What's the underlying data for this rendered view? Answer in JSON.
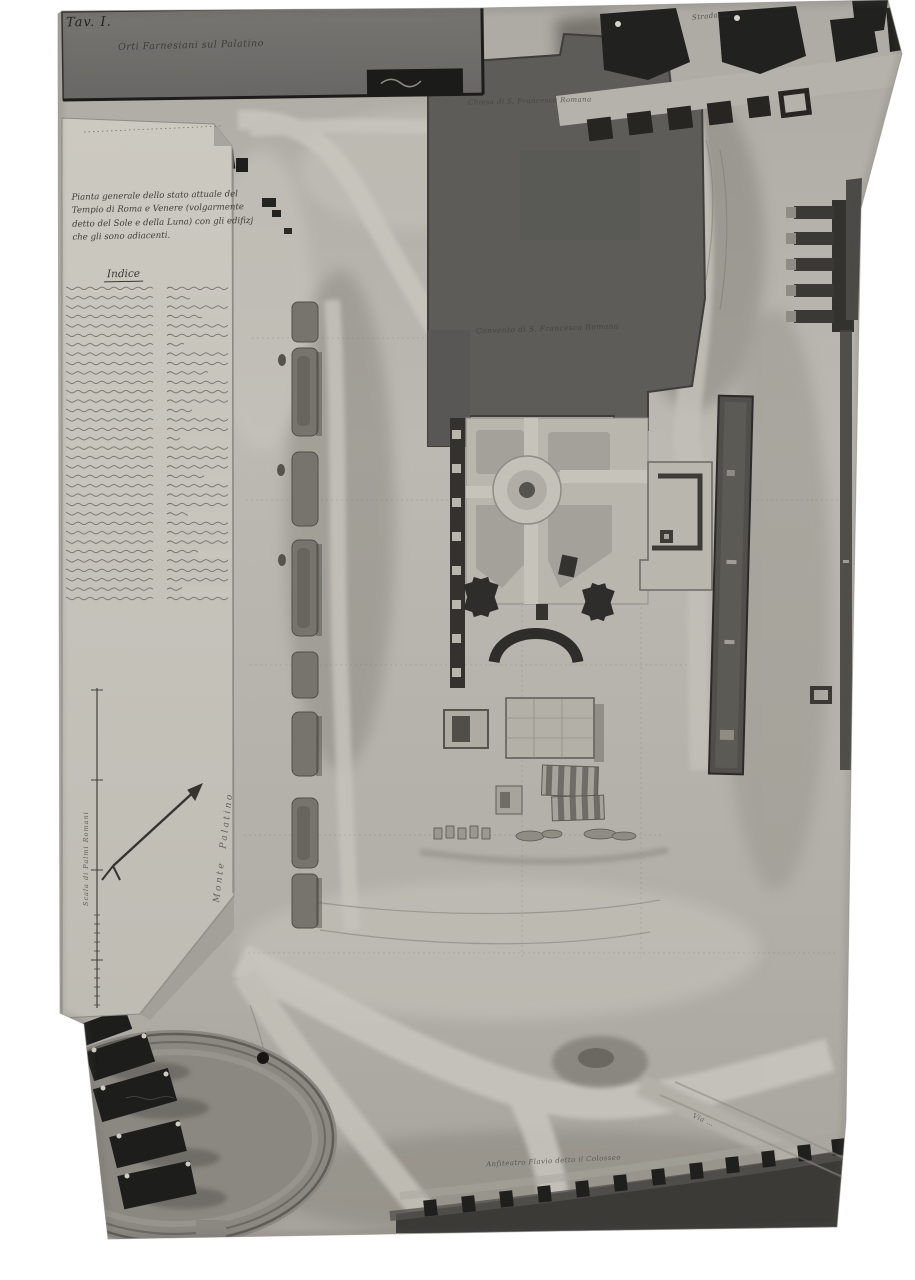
{
  "photo": {
    "plate_label": "Tav. I.",
    "archive_note": "Orti Farnesiani sul Palatino",
    "title_block": {
      "full": "Pianta generale dello stato attuale del Tempio di Roma e Venere (volgarmente detto del Sole e della Luna) con gli edifizj che gli sono adiacenti.",
      "lines": [
        "Pianta generale dello stato attuale del",
        "Tempio di Roma e Venere (volgarmente",
        "detto del Sole e della Luna) con gli edifizj",
        "che gli sono adiacenti."
      ]
    },
    "index": {
      "heading": "Indice"
    },
    "map_labels": {
      "church": "Chiesa di S. Francesca Romana",
      "convent": "Convento di S. Francesca Romana",
      "street_top": "Strada …",
      "colosseum": "Anfiteatro Flavio detto il Colosseo",
      "via_bottom_right": "Via …",
      "monte_palatino": "Monte Palatino",
      "scale_caption": "Scala di Palmi Romani"
    },
    "colors": {
      "margin": "#ffffff",
      "terrain": "#b6b3ac",
      "paper_sheet": "#c8c5bd",
      "dark_building": "#5d5c59",
      "ink": "#3a3933"
    }
  }
}
